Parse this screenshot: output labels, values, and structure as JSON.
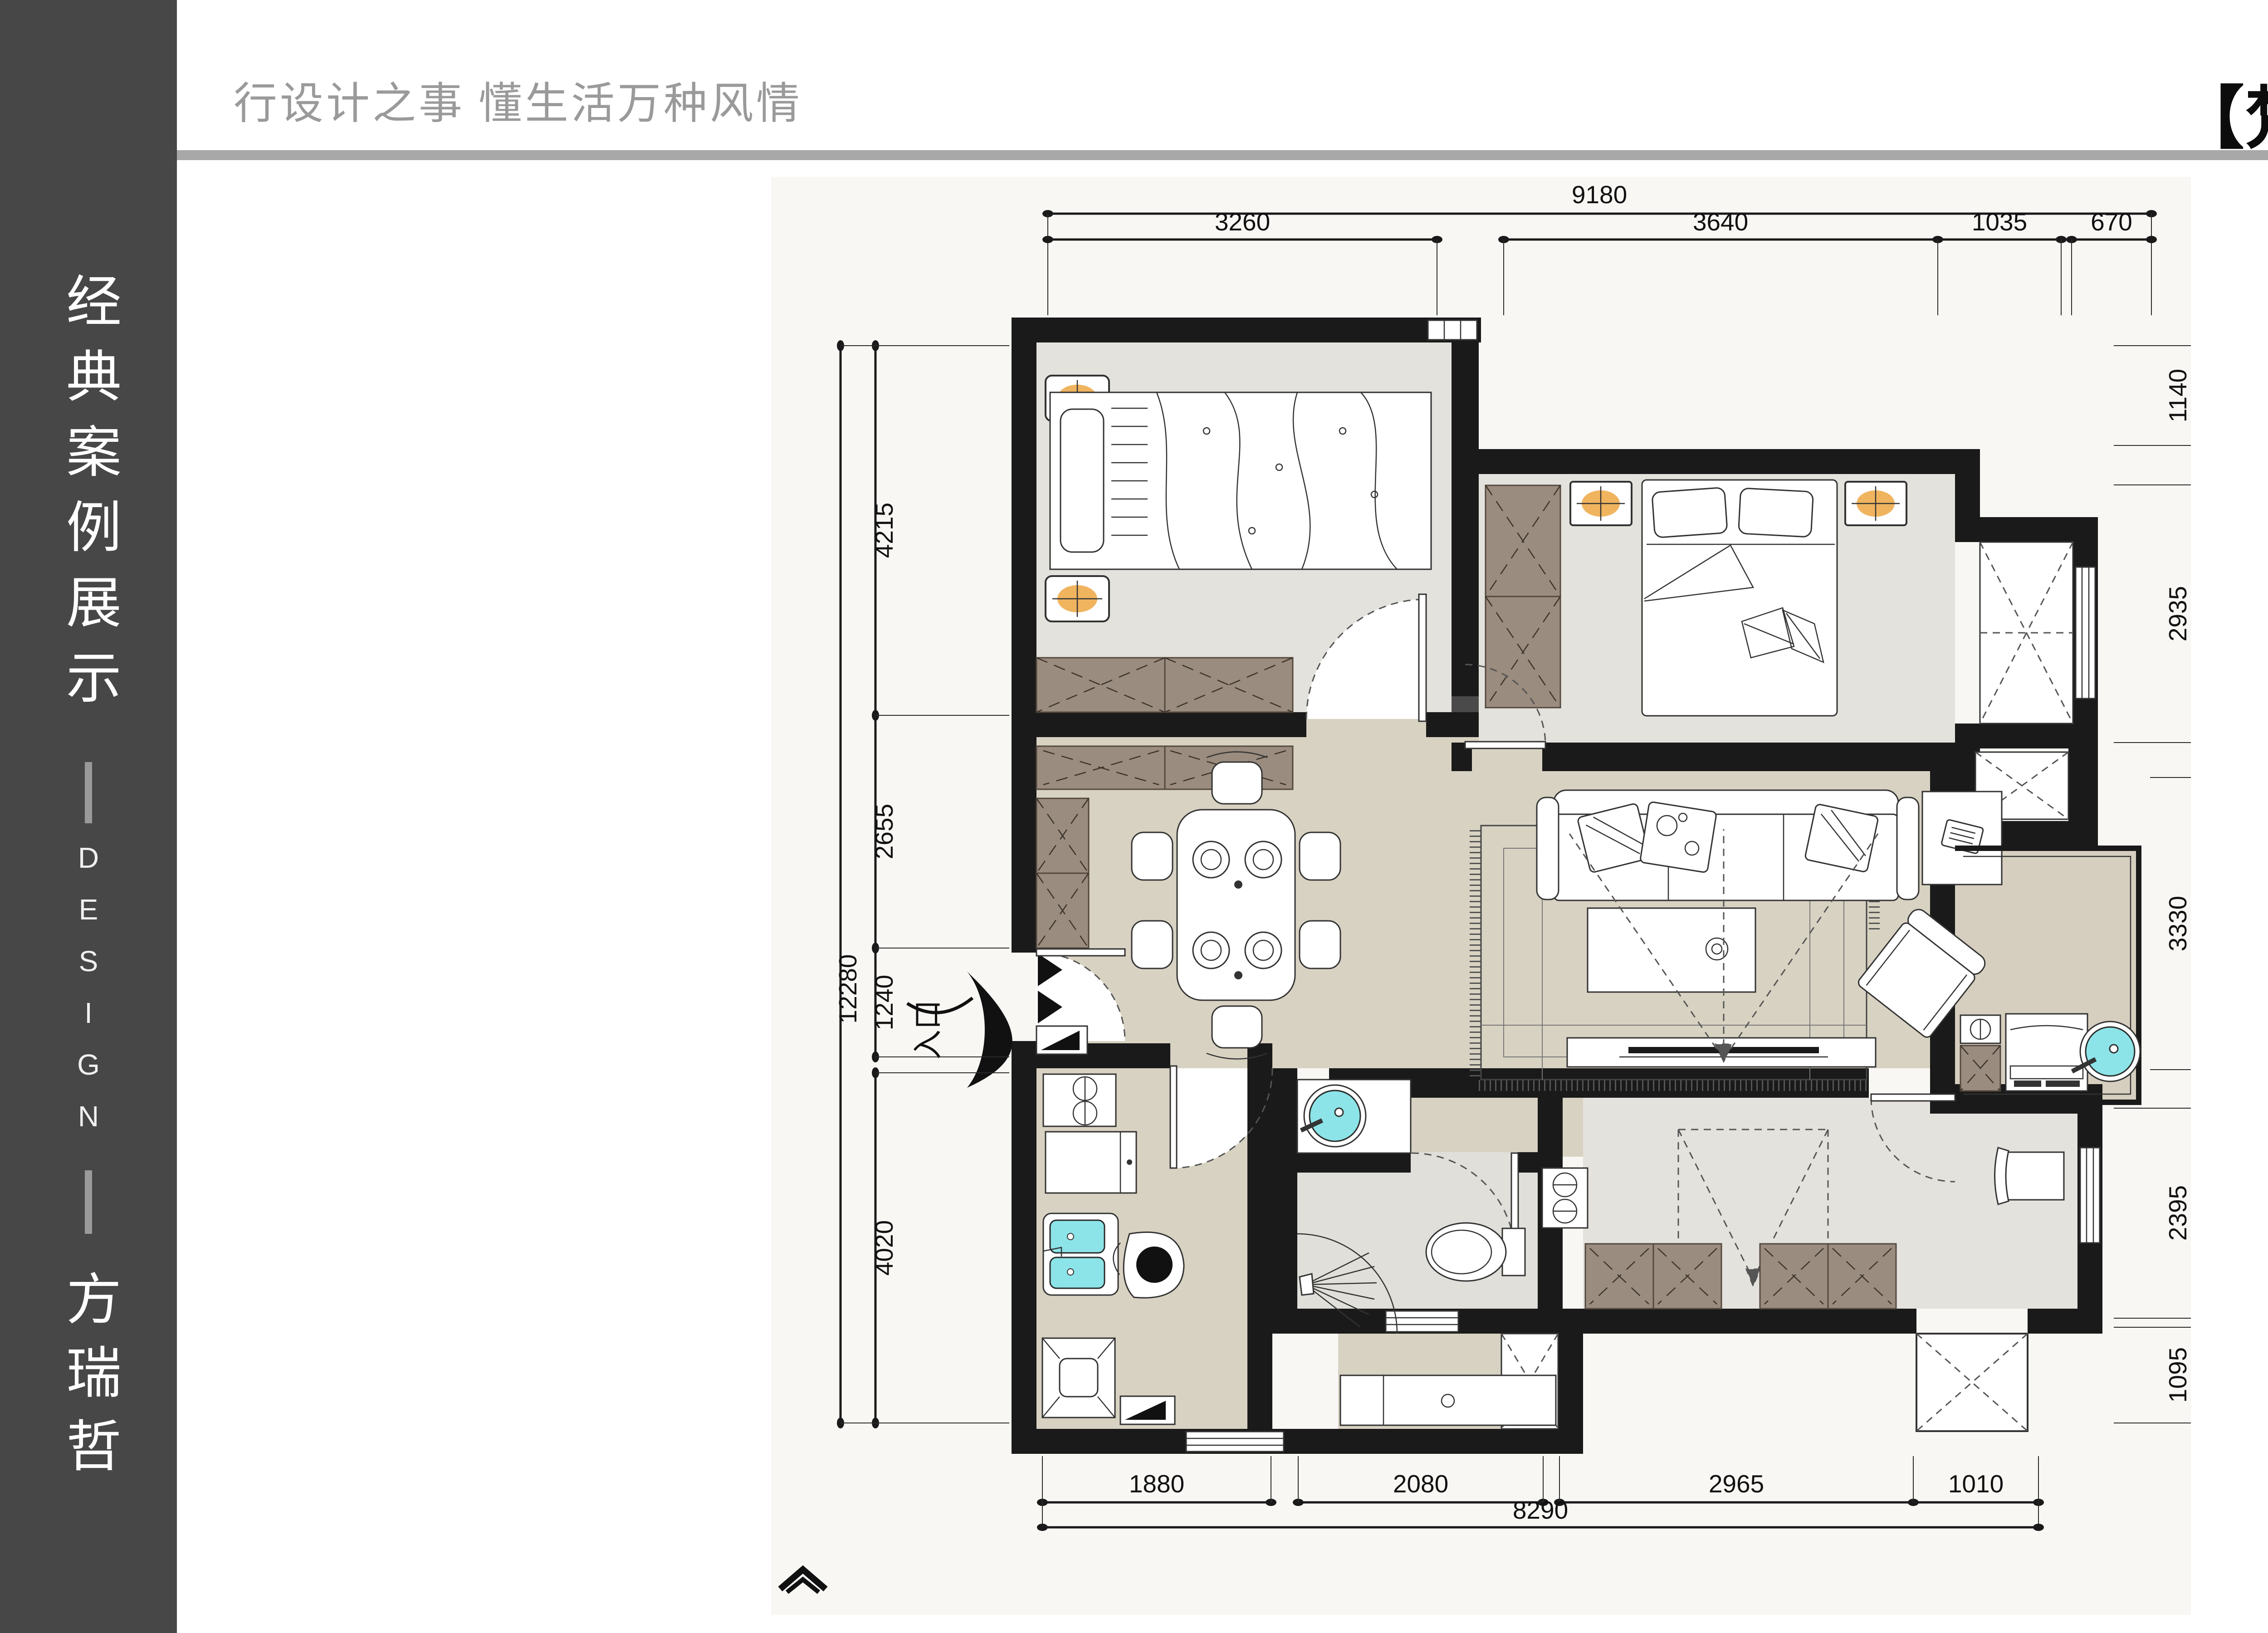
{
  "header": {
    "tagline": "行设计之事 懂生活万种风情",
    "title": "【梵高|先生】"
  },
  "sidebar": {
    "title_vertical": "经典案例展示",
    "subtitle_vertical": "DESIGN",
    "author_vertical": "方瑞哲"
  },
  "plan": {
    "entry_label": "入口",
    "dimensions": {
      "top": {
        "overall": "9180",
        "segments": [
          "3260",
          "3640",
          "1035",
          "670"
        ]
      },
      "bottom": {
        "overall": "8290",
        "segments": [
          "1880",
          "2080",
          "2965",
          "1010"
        ]
      },
      "left": {
        "overall": "12280",
        "segments": [
          "4215",
          "2655",
          "1240",
          "4020"
        ]
      },
      "right": {
        "overall": "12280",
        "segments": [
          "1140",
          "2935",
          "3330",
          "2395",
          "1095"
        ]
      }
    }
  },
  "colors": {
    "sidebar_bg": "#474747",
    "divider": "#a8a8a8",
    "tagline_gray": "#9a9a9a",
    "wall_black": "#1a1a1a",
    "floor_main": "#d8d2c2",
    "floor_room": "#e4e2dc",
    "floor_bath": "#e0dfd9",
    "floor_balcony": "#d6cfc0",
    "cabinet_brown": "#9a8c7e",
    "fixture_cyan": "#8ce4e8",
    "lamp_orange": "#f0b45f"
  }
}
